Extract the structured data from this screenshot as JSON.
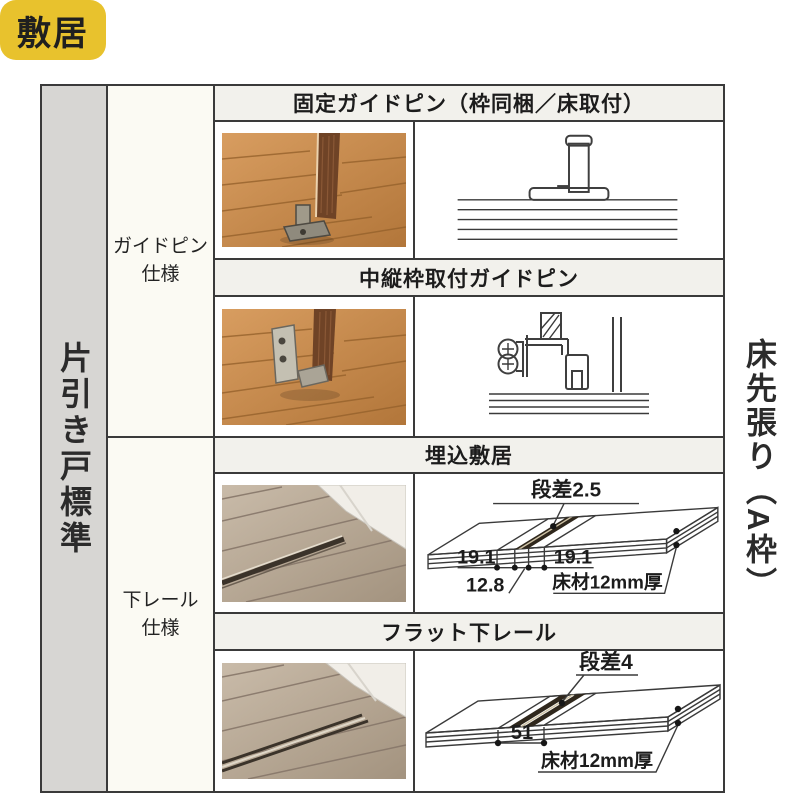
{
  "badge": {
    "label": "敷居"
  },
  "axes": {
    "left": "片引き戸標準",
    "right": "床先張り（A枠）"
  },
  "groups": [
    {
      "line1": "ガイドピン",
      "line2": "仕様"
    },
    {
      "line1": "下レール",
      "line2": "仕様"
    }
  ],
  "sections": [
    {
      "header": "固定ガイドピン（枠同梱／床取付）",
      "photo": "wood-floor-fixed-guide-pin-photo",
      "diagram": "fixed-guide-pin-section-drawing"
    },
    {
      "header": "中縦枠取付ガイドピン",
      "photo": "wood-floor-bracket-guide-pin-photo",
      "diagram": "mid-frame-guide-pin-section-drawing"
    },
    {
      "header": "埋込敷居",
      "photo": "floor-embedded-sill-photo",
      "diagram": "embedded-sill-section-drawing",
      "labels": {
        "step": "段差2.5",
        "dim_left": "19.1",
        "dim_right": "19.1",
        "dim_groove": "12.8",
        "floor": "床材12mm厚"
      }
    },
    {
      "header": "フラット下レール",
      "photo": "floor-flat-rail-photo",
      "diagram": "flat-rail-section-drawing",
      "labels": {
        "step": "段差4",
        "dim_width": "51",
        "floor": "床材12mm厚"
      }
    }
  ],
  "colors": {
    "badge_bg": "#e8c22d",
    "header_bg": "#f2f1ec",
    "group_cell_bg": "#fbfaf3",
    "axis_strip_bg": "#d7d6d3",
    "border": "#3a3a3a",
    "wood_warm": "#c8874b",
    "wood_gray": "#b3a294",
    "rail_dark": "#32291e",
    "diagram_floor": "#f3ecda"
  }
}
